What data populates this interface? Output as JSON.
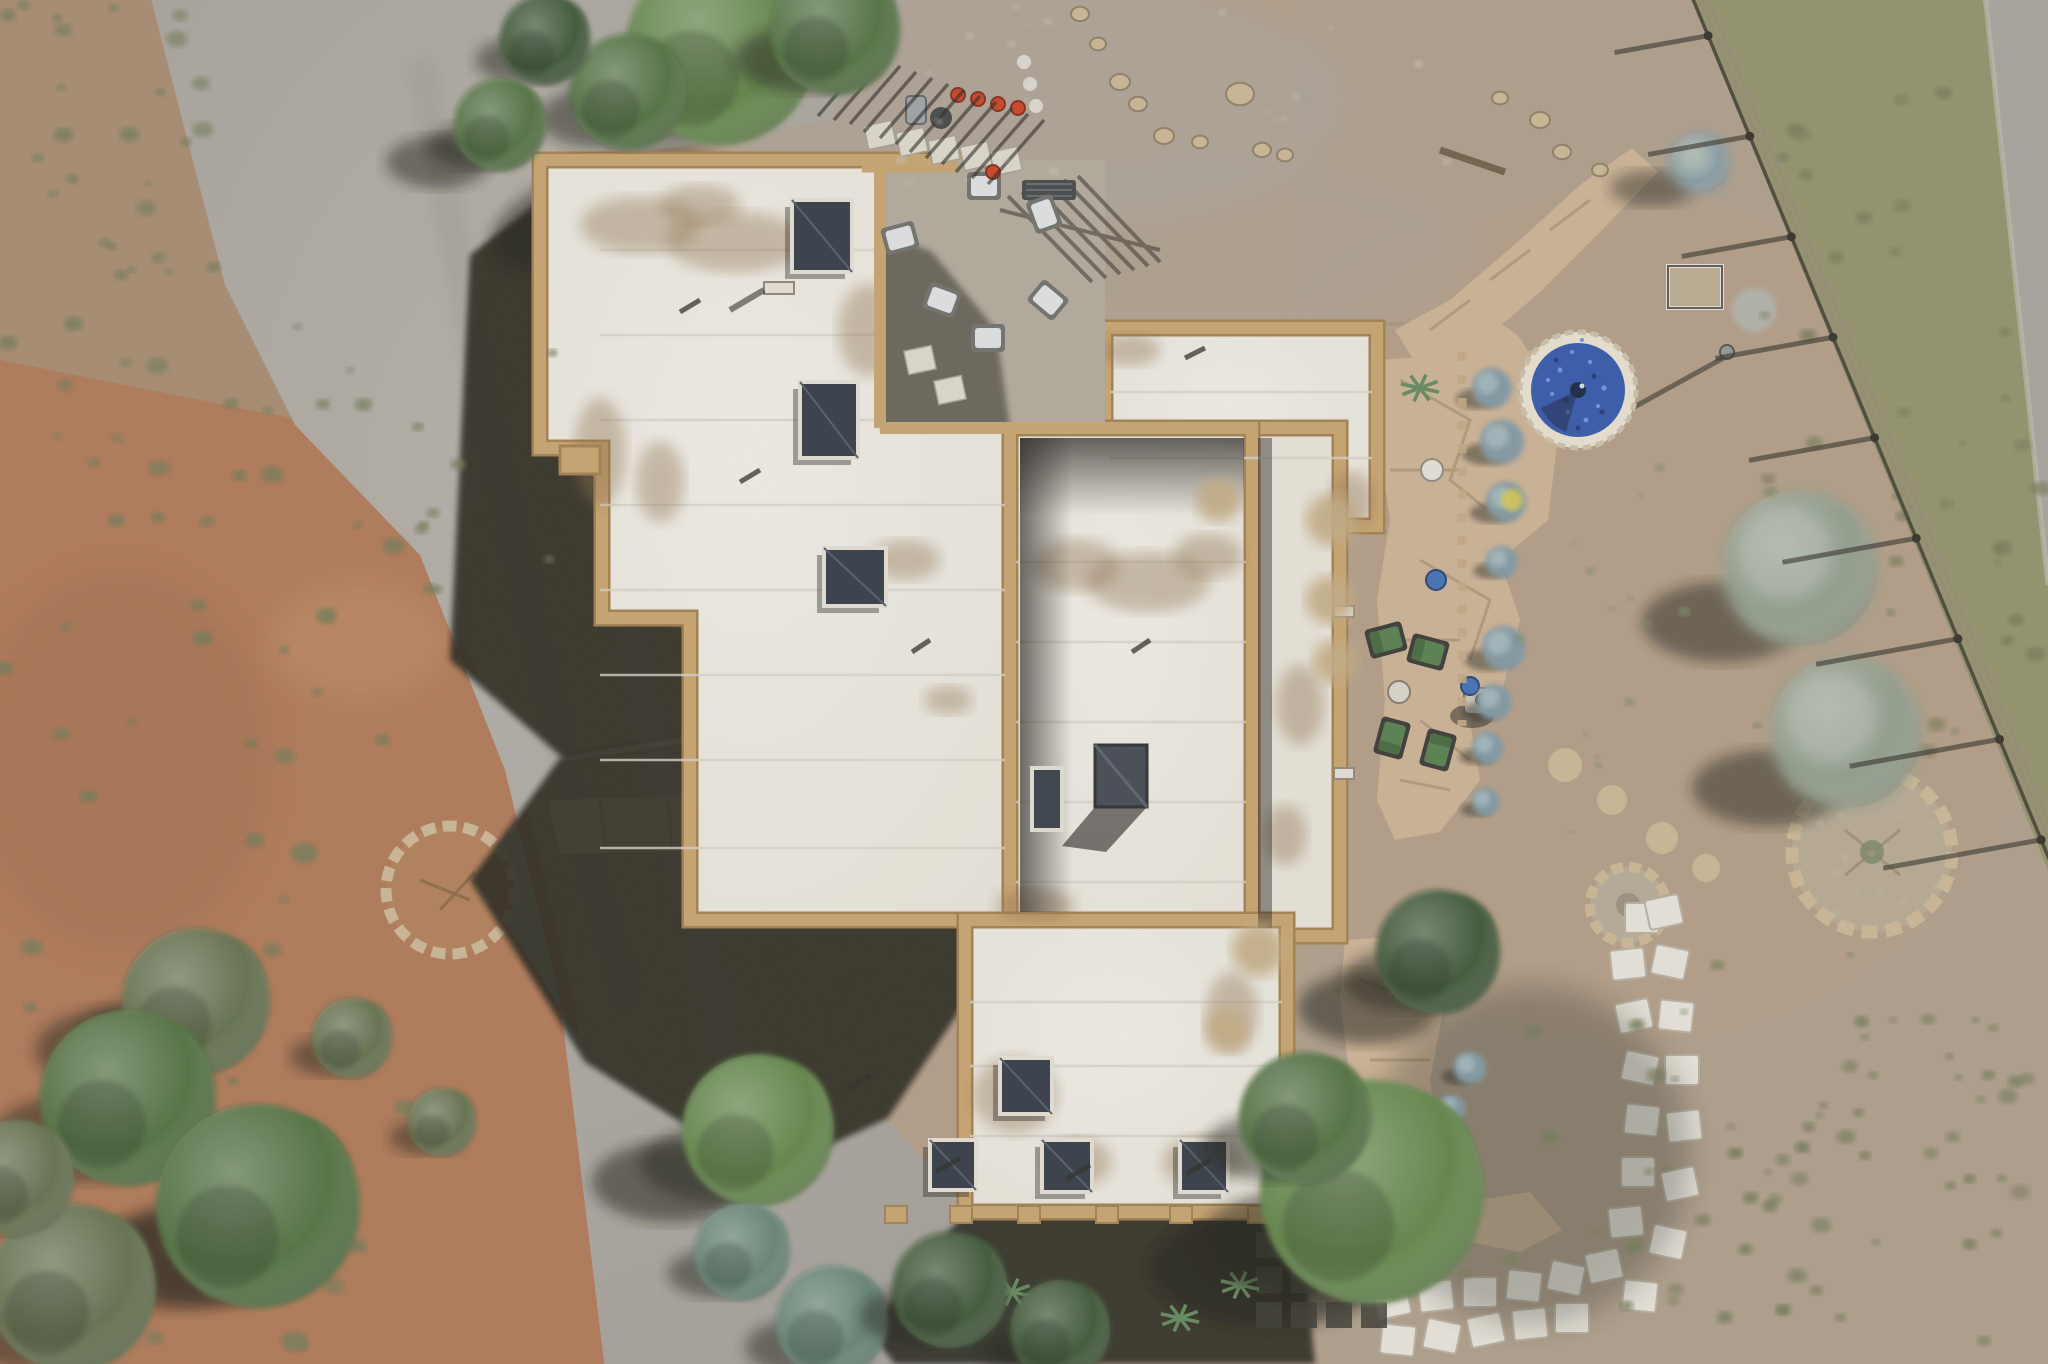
{
  "meta": {
    "description": "Aerial top-down drone photograph of a white flat-roofed adobe style house with tan parapet walls in a high-desert lot, with a curved gravel driveway, flagstone patios, a round blue glass fountain, a rail fence, stepping-stone path, desert scrub and trees",
    "type": "aerial-photograph",
    "time_of_day": "midday, sun from upper right casting shadows to lower left"
  },
  "palette": {
    "dirt": "#b19a82",
    "dirtDark": "#9f8a72",
    "dirtTop": "#a99e8d",
    "redDirt": "#ae7350",
    "redDirtDark": "#9a6443",
    "gravel": "#a8a39b",
    "gravelLight": "#bab5ad",
    "gravelDark": "#918d86",
    "road": "#a5a19a",
    "grass": "#8e8e66",
    "grassDark": "#6f7350",
    "scrub": "#6c7550",
    "scrubSm": "#7d8a64",
    "treeDark": "#35502e",
    "treeMid": "#4a6a38",
    "treeBright": "#5a8040",
    "treeOlive": "#5c6b44",
    "spruce": "#5e7f70",
    "sage": "#8d9a88",
    "sageBlue": "#7e98a2",
    "chamisa": "#c2a97e",
    "roof": "#eeebe3",
    "roofShade": "#e0dcd1",
    "stain": "#8a6b42",
    "parapet": "#c7a169",
    "parapetDark": "#a07a48",
    "shadow": "#15130f",
    "flag": "#cbb091",
    "flagLight": "#dcc6a4",
    "flagGap": "#a8906f",
    "paver": "#e8e4da",
    "fountainBlue": "#2c50a8",
    "fountainDeep": "#17316e",
    "fountainRing": "#eae1cf",
    "chairGreen": "#4e7a47",
    "chairWhite": "#dfe2e3",
    "potRed": "#cc3a1a",
    "potBlue": "#3a6ab5",
    "fencePost": "#2b2820",
    "fenceRail": "#8f8672",
    "pebble": "#c7bfae",
    "stone": "#c9b592"
  },
  "scene": {
    "ground": {
      "driveway": "curved gray gravel driveway sweeping from top left to bottom center",
      "left_strip": "reddish brown dirt with olive desert scrub along left edge",
      "right_yard": "tan dirt yard with flagstone paths and plantings",
      "road": "gravel road strip at far top right corner"
    },
    "house": {
      "label": "white flat-roof pueblo house with tan parapets",
      "wings": [
        {
          "name": "northwest-wing",
          "path": "M540,160 H1010 V920 H690 V618 H602 V448 H540 Z"
        },
        {
          "name": "northeast-wing",
          "x": 1105,
          "y": 328,
          "w": 272,
          "h": 198
        },
        {
          "name": "east-portal",
          "x": 1252,
          "y": 428,
          "w": 88,
          "h": 508
        },
        {
          "name": "center-wing",
          "x": 1010,
          "y": 428,
          "w": 242,
          "h": 492
        },
        {
          "name": "south-wing",
          "x": 965,
          "y": 920,
          "w": 322,
          "h": 292
        }
      ],
      "courtyard_notch": {
        "x": 880,
        "y": 160,
        "w": 225,
        "h": 268
      },
      "skylights_nw": [
        [
          792,
          200,
          60,
          72
        ],
        [
          800,
          382,
          58,
          76
        ],
        [
          824,
          548,
          62,
          58
        ]
      ],
      "skylights_south": [
        [
          1000,
          1058,
          52,
          56
        ],
        [
          930,
          1140,
          46,
          50
        ],
        [
          1042,
          1140,
          50,
          52
        ],
        [
          1180,
          1140,
          48,
          52
        ]
      ],
      "skylight_center": [
        1032,
        768,
        30,
        62
      ],
      "chimney": [
        1095,
        745,
        52,
        62
      ],
      "parapet_tabs_x": [
        885,
        950,
        1018,
        1096,
        1170,
        1248
      ],
      "seams": [
        {
          "x1": 600,
          "x2": 1005,
          "ys": [
            250,
            335,
            420,
            505,
            590,
            675,
            760,
            848
          ]
        },
        {
          "x1": 1110,
          "x2": 1372,
          "ys": [
            392,
            458
          ]
        },
        {
          "x1": 1016,
          "x2": 1246,
          "ys": [
            562,
            642,
            722,
            802,
            882
          ]
        },
        {
          "x1": 970,
          "x2": 1282,
          "ys": [
            1002,
            1066,
            1136
          ]
        }
      ],
      "stains": [
        [
          640,
          225,
          60,
          28
        ],
        [
          735,
          242,
          70,
          30
        ],
        [
          700,
          205,
          40,
          20
        ],
        [
          600,
          452,
          26,
          54
        ],
        [
          660,
          482,
          24,
          40
        ],
        [
          905,
          560,
          35,
          20
        ],
        [
          1075,
          565,
          45,
          26
        ],
        [
          1148,
          582,
          62,
          30
        ],
        [
          1208,
          556,
          35,
          22
        ],
        [
          1035,
          905,
          40,
          16
        ],
        [
          1300,
          705,
          24,
          40
        ],
        [
          1285,
          835,
          22,
          30
        ],
        [
          1015,
          1095,
          42,
          38
        ],
        [
          1078,
          1162,
          34,
          24
        ],
        [
          1202,
          1162,
          40,
          26
        ],
        [
          1232,
          1012,
          26,
          40
        ],
        [
          1130,
          350,
          30,
          16
        ],
        [
          1352,
          500,
          22,
          28
        ],
        [
          948,
          700,
          24,
          14
        ],
        [
          868,
          330,
          30,
          46
        ]
      ]
    },
    "courtyard": {
      "chairs": [
        [
          900,
          238,
          -15
        ],
        [
          942,
          300,
          20
        ],
        [
          988,
          338,
          0
        ],
        [
          1048,
          300,
          40
        ],
        [
          1044,
          214,
          70
        ],
        [
          984,
          186,
          0
        ]
      ],
      "red_pots": [
        [
          958,
          95
        ],
        [
          978,
          99
        ],
        [
          998,
          104
        ],
        [
          1018,
          108
        ],
        [
          993,
          172
        ]
      ],
      "pavers": [
        [
          880,
          135
        ],
        [
          912,
          142
        ],
        [
          944,
          150
        ],
        [
          976,
          156
        ],
        [
          1006,
          161
        ],
        [
          920,
          360
        ],
        [
          950,
          390
        ]
      ]
    },
    "east_patio": {
      "green_chairs": [
        [
          1386,
          640,
          -15
        ],
        [
          1428,
          652,
          15
        ],
        [
          1392,
          738,
          -75
        ],
        [
          1438,
          750,
          105
        ]
      ],
      "fire_table": [
        1482,
        700
      ],
      "white_pot": [
        1432,
        470
      ],
      "blue_pots": [
        [
          1436,
          580
        ],
        [
          1470,
          686
        ]
      ],
      "sage_row": [
        [
          1492,
          388,
          20
        ],
        [
          1502,
          442,
          22
        ],
        [
          1506,
          502,
          20
        ],
        [
          1502,
          562,
          16
        ],
        [
          1504,
          648,
          22
        ],
        [
          1494,
          702,
          18
        ],
        [
          1488,
          748,
          16
        ],
        [
          1486,
          802,
          14
        ],
        [
          1470,
          1068,
          16
        ],
        [
          1452,
          1108,
          13
        ]
      ],
      "yellow_flowers": [
        1512,
        500
      ]
    },
    "fountain": {
      "cx": 1578,
      "cy": 390,
      "r": 48,
      "ring_r": 58,
      "label": "round cobalt blue glass fountain with stone ring"
    },
    "windmill": {
      "cx": 1727,
      "cy": 352,
      "label": "metal yard ornament with long shadow"
    },
    "planter_frame": {
      "x": 1668,
      "y": 266,
      "w": 54,
      "h": 42
    },
    "fence": {
      "x1": 1690,
      "y1": -8,
      "x2": 2052,
      "y2": 866,
      "posts": 9,
      "label": "diagonal rail fence with long post shadows"
    },
    "road_edge": [
      [
        1985,
        0
      ],
      [
        2048,
        560
      ]
    ],
    "fire_circle": {
      "cx": 1628,
      "cy": 905,
      "r": 38
    },
    "garden_circle": {
      "cx": 1872,
      "cy": 852,
      "r": 80
    },
    "left_stone_circle": {
      "cx": 450,
      "cy": 890,
      "r": 64
    },
    "stepping_stones": [
      [
        1392,
        1302
      ],
      [
        1436,
        1296
      ],
      [
        1480,
        1292
      ],
      [
        1524,
        1286
      ],
      [
        1566,
        1278
      ],
      [
        1604,
        1266
      ],
      [
        1626,
        1222
      ],
      [
        1638,
        1172
      ],
      [
        1642,
        1120
      ],
      [
        1640,
        1068
      ],
      [
        1634,
        1016
      ],
      [
        1628,
        964
      ],
      [
        1642,
        918
      ],
      [
        1398,
        1340
      ],
      [
        1442,
        1336
      ],
      [
        1486,
        1330
      ],
      [
        1530,
        1324
      ],
      [
        1572,
        1318
      ],
      [
        1640,
        1296
      ],
      [
        1668,
        1242
      ],
      [
        1680,
        1184
      ],
      [
        1684,
        1126
      ],
      [
        1682,
        1070
      ],
      [
        1676,
        1016
      ],
      [
        1670,
        962
      ],
      [
        1664,
        912
      ]
    ],
    "trees": [
      {
        "cx": 720,
        "cy": 50,
        "r": 95,
        "tone": "treeBright"
      },
      {
        "cx": 835,
        "cy": 30,
        "r": 65,
        "tone": "treeMid"
      },
      {
        "cx": 628,
        "cy": 92,
        "r": 58,
        "tone": "treeMid"
      },
      {
        "cx": 545,
        "cy": 40,
        "r": 45,
        "tone": "treeDark"
      },
      {
        "cx": 500,
        "cy": 125,
        "r": 46,
        "tone": "treeMid"
      },
      {
        "cx": 1438,
        "cy": 952,
        "r": 62,
        "tone": "treeDark"
      },
      {
        "cx": 1372,
        "cy": 1192,
        "r": 112,
        "tone": "treeBright"
      },
      {
        "cx": 1305,
        "cy": 1118,
        "r": 66,
        "tone": "treeMid"
      },
      {
        "cx": 758,
        "cy": 1130,
        "r": 76,
        "tone": "treeBright"
      },
      {
        "cx": 742,
        "cy": 1252,
        "r": 48,
        "tone": "spruce"
      },
      {
        "cx": 832,
        "cy": 1322,
        "r": 56,
        "tone": "spruce"
      },
      {
        "cx": 196,
        "cy": 1002,
        "r": 74,
        "tone": "treeOlive"
      },
      {
        "cx": 128,
        "cy": 1098,
        "r": 88,
        "tone": "treeMid"
      },
      {
        "cx": 258,
        "cy": 1206,
        "r": 102,
        "tone": "treeMid"
      },
      {
        "cx": 72,
        "cy": 1288,
        "r": 84,
        "tone": "treeOlive"
      },
      {
        "cx": 16,
        "cy": 1178,
        "r": 58,
        "tone": "treeOlive"
      },
      {
        "cx": 352,
        "cy": 1038,
        "r": 40,
        "tone": "treeOlive"
      },
      {
        "cx": 442,
        "cy": 1122,
        "r": 34,
        "tone": "treeOlive"
      },
      {
        "cx": 950,
        "cy": 1290,
        "r": 58,
        "tone": "treeDark"
      },
      {
        "cx": 1060,
        "cy": 1330,
        "r": 50,
        "tone": "treeDark"
      }
    ],
    "shrubs": [
      {
        "cx": 1800,
        "cy": 568,
        "r": 78,
        "tone": "sage"
      },
      {
        "cx": 1846,
        "cy": 732,
        "r": 76,
        "tone": "sage"
      },
      {
        "cx": 1700,
        "cy": 163,
        "r": 30,
        "tone": "sageBlue"
      }
    ],
    "chamisa_fluffs": [
      [
        1332,
        520,
        26
      ],
      [
        1330,
        600,
        24
      ],
      [
        1335,
        662,
        22
      ],
      [
        1218,
        500,
        22
      ],
      [
        1258,
        950,
        26
      ],
      [
        1227,
        1030,
        22
      ]
    ],
    "rocks": [
      [
        1080,
        14,
        9
      ],
      [
        1098,
        44,
        8
      ],
      [
        1120,
        82,
        10
      ],
      [
        1138,
        104,
        9
      ],
      [
        1164,
        136,
        10
      ],
      [
        1200,
        142,
        8
      ],
      [
        1240,
        94,
        14
      ],
      [
        1262,
        150,
        9
      ],
      [
        1285,
        155,
        8
      ],
      [
        1500,
        98,
        8
      ],
      [
        1540,
        120,
        10
      ],
      [
        1562,
        152,
        9
      ],
      [
        1600,
        170,
        8
      ]
    ],
    "yuccas": [
      [
        1180,
        1318
      ],
      [
        1240,
        1285
      ],
      [
        1420,
        388
      ],
      [
        1012,
        1292
      ]
    ],
    "dark_paver_grid": {
      "x": 1256,
      "y": 1232,
      "cols": 4,
      "rows": 3,
      "size": 26,
      "gap": 9
    },
    "speckle_regions": [
      {
        "x": 0,
        "y": 0,
        "w": 215,
        "h": 300,
        "n": 26,
        "c": "scrub",
        "rmin": 4,
        "rmax": 11
      },
      {
        "x": 0,
        "y": 300,
        "w": 400,
        "h": 500,
        "n": 34,
        "c": "scrub",
        "rmin": 4,
        "rmax": 12
      },
      {
        "x": 0,
        "y": 800,
        "w": 540,
        "h": 560,
        "n": 26,
        "c": "scrub",
        "rmin": 5,
        "rmax": 14
      },
      {
        "x": 1755,
        "y": 70,
        "w": 290,
        "h": 720,
        "n": 44,
        "c": "grassDark",
        "rmin": 4,
        "rmax": 10
      },
      {
        "x": 1430,
        "y": 1020,
        "w": 600,
        "h": 340,
        "n": 48,
        "c": "scrub",
        "rmin": 4,
        "rmax": 10
      },
      {
        "x": 340,
        "y": 330,
        "w": 240,
        "h": 260,
        "n": 10,
        "c": "scrub",
        "rmin": 4,
        "rmax": 9
      },
      {
        "x": 900,
        "y": 0,
        "w": 560,
        "h": 190,
        "n": 24,
        "c": "pebble",
        "rmin": 2,
        "rmax": 5
      },
      {
        "x": 1500,
        "y": 430,
        "w": 200,
        "h": 420,
        "n": 14,
        "c": "scrubSm",
        "rmin": 3,
        "rmax": 6
      },
      {
        "x": 1620,
        "y": 950,
        "w": 380,
        "h": 260,
        "n": 20,
        "c": "scrub",
        "rmin": 3,
        "rmax": 8
      },
      {
        "x": 1800,
        "y": 780,
        "w": 150,
        "h": 150,
        "n": 22,
        "c": "pebble",
        "rmin": 2,
        "rmax": 4
      }
    ]
  }
}
